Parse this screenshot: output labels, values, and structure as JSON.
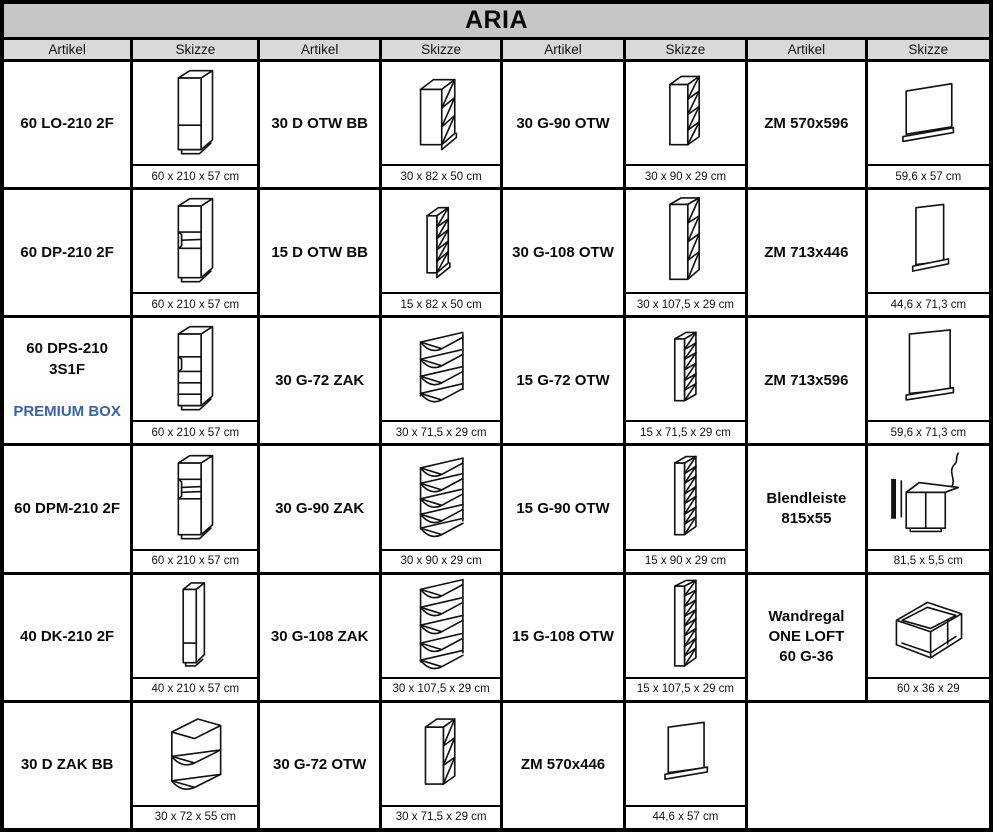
{
  "title": "ARIA",
  "header": {
    "artikel": "Artikel",
    "skizze": "Skizze"
  },
  "colors": {
    "title_bg": "#c6c6c6",
    "header_bg": "#d9d9d9",
    "border": "#000000",
    "premium_box_blue": "#3A62AD"
  },
  "rows": [
    [
      {
        "article": "60 LO-210 2F",
        "sketch": "tall-cabinet-2-door",
        "dims": "60 x 210 x 57 cm"
      },
      {
        "article": "30 D OTW BB",
        "sketch": "base-open-shelf-cabinet",
        "dims": "30 x 82 x 50 cm"
      },
      {
        "article": "30 G-90 OTW",
        "sketch": "wall-open-shelf-4",
        "dims": "30 x 90 x 29 cm"
      },
      {
        "article": "ZM 570x596",
        "sketch": "appliance-front-panel-wide",
        "dims": "59,6 x 57 cm"
      }
    ],
    [
      {
        "article": "60 DP-210 2F",
        "sketch": "tall-oven-cabinet",
        "dims": "60 x 210 x 57 cm"
      },
      {
        "article": "15 D OTW BB",
        "sketch": "narrow-base-open-shelf",
        "dims": "15 x 82 x 50 cm"
      },
      {
        "article": "30 G-108 OTW",
        "sketch": "wall-open-shelf-4-tall",
        "dims": "30 x 107,5 x 29 cm"
      },
      {
        "article": "ZM 713x446",
        "sketch": "appliance-front-panel-tall-narrow",
        "dims": "44,6 x 71,3 cm"
      }
    ],
    [
      {
        "article": "60 DPS-210 3S1F",
        "subtitle": "PREMIUM BOX",
        "sketch": "tall-drawer-cabinet",
        "dims": "60 x 210 x 57 cm"
      },
      {
        "article": "30 G-72 ZAK",
        "sketch": "corner-open-shelf-4",
        "dims": "30 x 71,5 x 29 cm"
      },
      {
        "article": "15 G-72 OTW",
        "sketch": "narrow-wall-open-shelf-6",
        "dims": "15 x 71,5 x 29 cm"
      },
      {
        "article": "ZM 713x596",
        "sketch": "appliance-front-panel-tall-wide",
        "dims": "59,6 x 71,3 cm"
      }
    ],
    [
      {
        "article": "60 DPM-210 2F",
        "sketch": "tall-microwave-cabinet",
        "dims": "60 x 210 x 57 cm"
      },
      {
        "article": "30 G-90 ZAK",
        "sketch": "corner-open-shelf-5",
        "dims": "30 x 90 x 29 cm"
      },
      {
        "article": "15 G-90 OTW",
        "sketch": "narrow-wall-open-shelf-7",
        "dims": "15 x 90 x 29 cm"
      },
      {
        "article": "Blendleiste\n815x55",
        "sketch": "filler-strip-with-base-cabinet",
        "dims": "81,5 x 5,5 cm"
      }
    ],
    [
      {
        "article": "40 DK-210 2F",
        "sketch": "tall-narrow-cabinet-2-door",
        "dims": "40 x 210 x 57 cm"
      },
      {
        "article": "30 G-108 ZAK",
        "sketch": "corner-open-shelf-5-tall",
        "dims": "30 x 107,5 x 29 cm"
      },
      {
        "article": "15 G-108 OTW",
        "sketch": "narrow-wall-open-shelf-8",
        "dims": "15 x 107,5 x 29 cm"
      },
      {
        "article": "Wandregal\nONE LOFT\n60 G-36",
        "sketch": "open-frame-wall-shelf",
        "dims": "60 x 36 x 29"
      }
    ],
    [
      {
        "article": "30 D ZAK BB",
        "sketch": "base-corner-open-shelf",
        "dims": "30 x 72 x 55 cm"
      },
      {
        "article": "30 G-72 OTW",
        "sketch": "wall-open-shelf-3",
        "dims": "30 x 71,5 x 29 cm"
      },
      {
        "article": "ZM 570x446",
        "sketch": "appliance-front-panel-small",
        "dims": "44,6 x 57 cm"
      },
      {
        "article": "",
        "sketch": "",
        "dims": ""
      }
    ]
  ]
}
